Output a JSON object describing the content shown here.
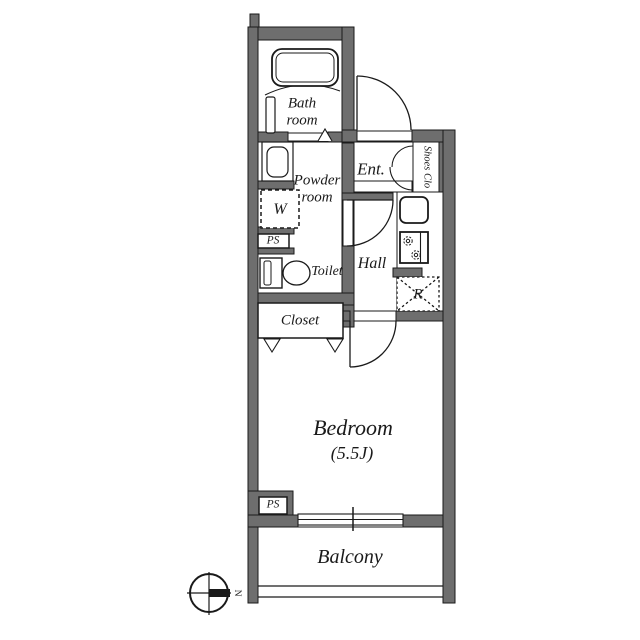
{
  "rooms": {
    "bathroom": {
      "line1": "Bath",
      "line2": "room"
    },
    "powder_room": {
      "line1": "Powder",
      "line2": "room"
    },
    "entrance": {
      "label": "Ent."
    },
    "shoes_closet": {
      "label": "Shoes Clo"
    },
    "hall": {
      "label": "Hall"
    },
    "toilet": {
      "label": "Toilet"
    },
    "closet": {
      "label": "Closet"
    },
    "bedroom": {
      "label": "Bedroom",
      "size": "(5.5J)"
    },
    "balcony": {
      "label": "Balcony"
    }
  },
  "fixtures": {
    "washing_machine": {
      "label": "W"
    },
    "pipe_space_upper": {
      "label": "PS"
    },
    "pipe_space_lower": {
      "label": "PS"
    },
    "refrigerator": {
      "label": "R"
    }
  },
  "compass": {
    "north": "N"
  },
  "colors": {
    "wall_fill": "#6e6e6e",
    "outline": "#1a1a1a",
    "background": "#ffffff"
  }
}
